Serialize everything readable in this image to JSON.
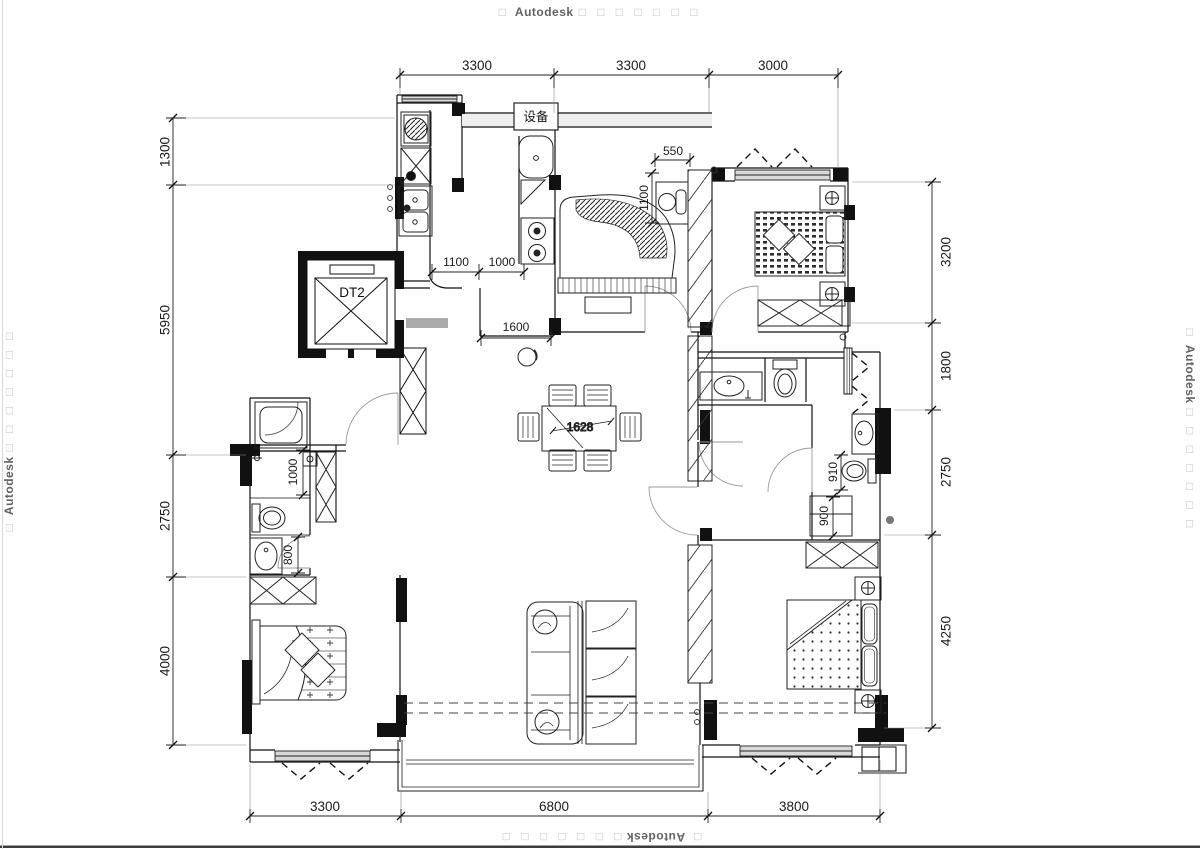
{
  "watermark": {
    "prefix": "□",
    "name": "Autodesk",
    "suffix": "□ □ □ □ □ □ □"
  },
  "dims": {
    "top": [
      "3300",
      "3300",
      "3000"
    ],
    "bottom": [
      "3300",
      "6800",
      "3800"
    ],
    "left": [
      "1300",
      "5950",
      "2750",
      "4000"
    ],
    "right": [
      "3200",
      "1800",
      "2750",
      "4250"
    ]
  },
  "interior": {
    "kitchen_left": "1100",
    "kitchen_right": "1000",
    "hallway": "1600",
    "desk_width": "550",
    "desk_depth": "1100",
    "dining_table": "1628",
    "bath_right_upper": "910",
    "bath_right_lower": "900",
    "bath_left_upper": "1000",
    "bath_left_lower": "800"
  },
  "labels": {
    "equipment": "设备",
    "elevator": "DT2"
  }
}
